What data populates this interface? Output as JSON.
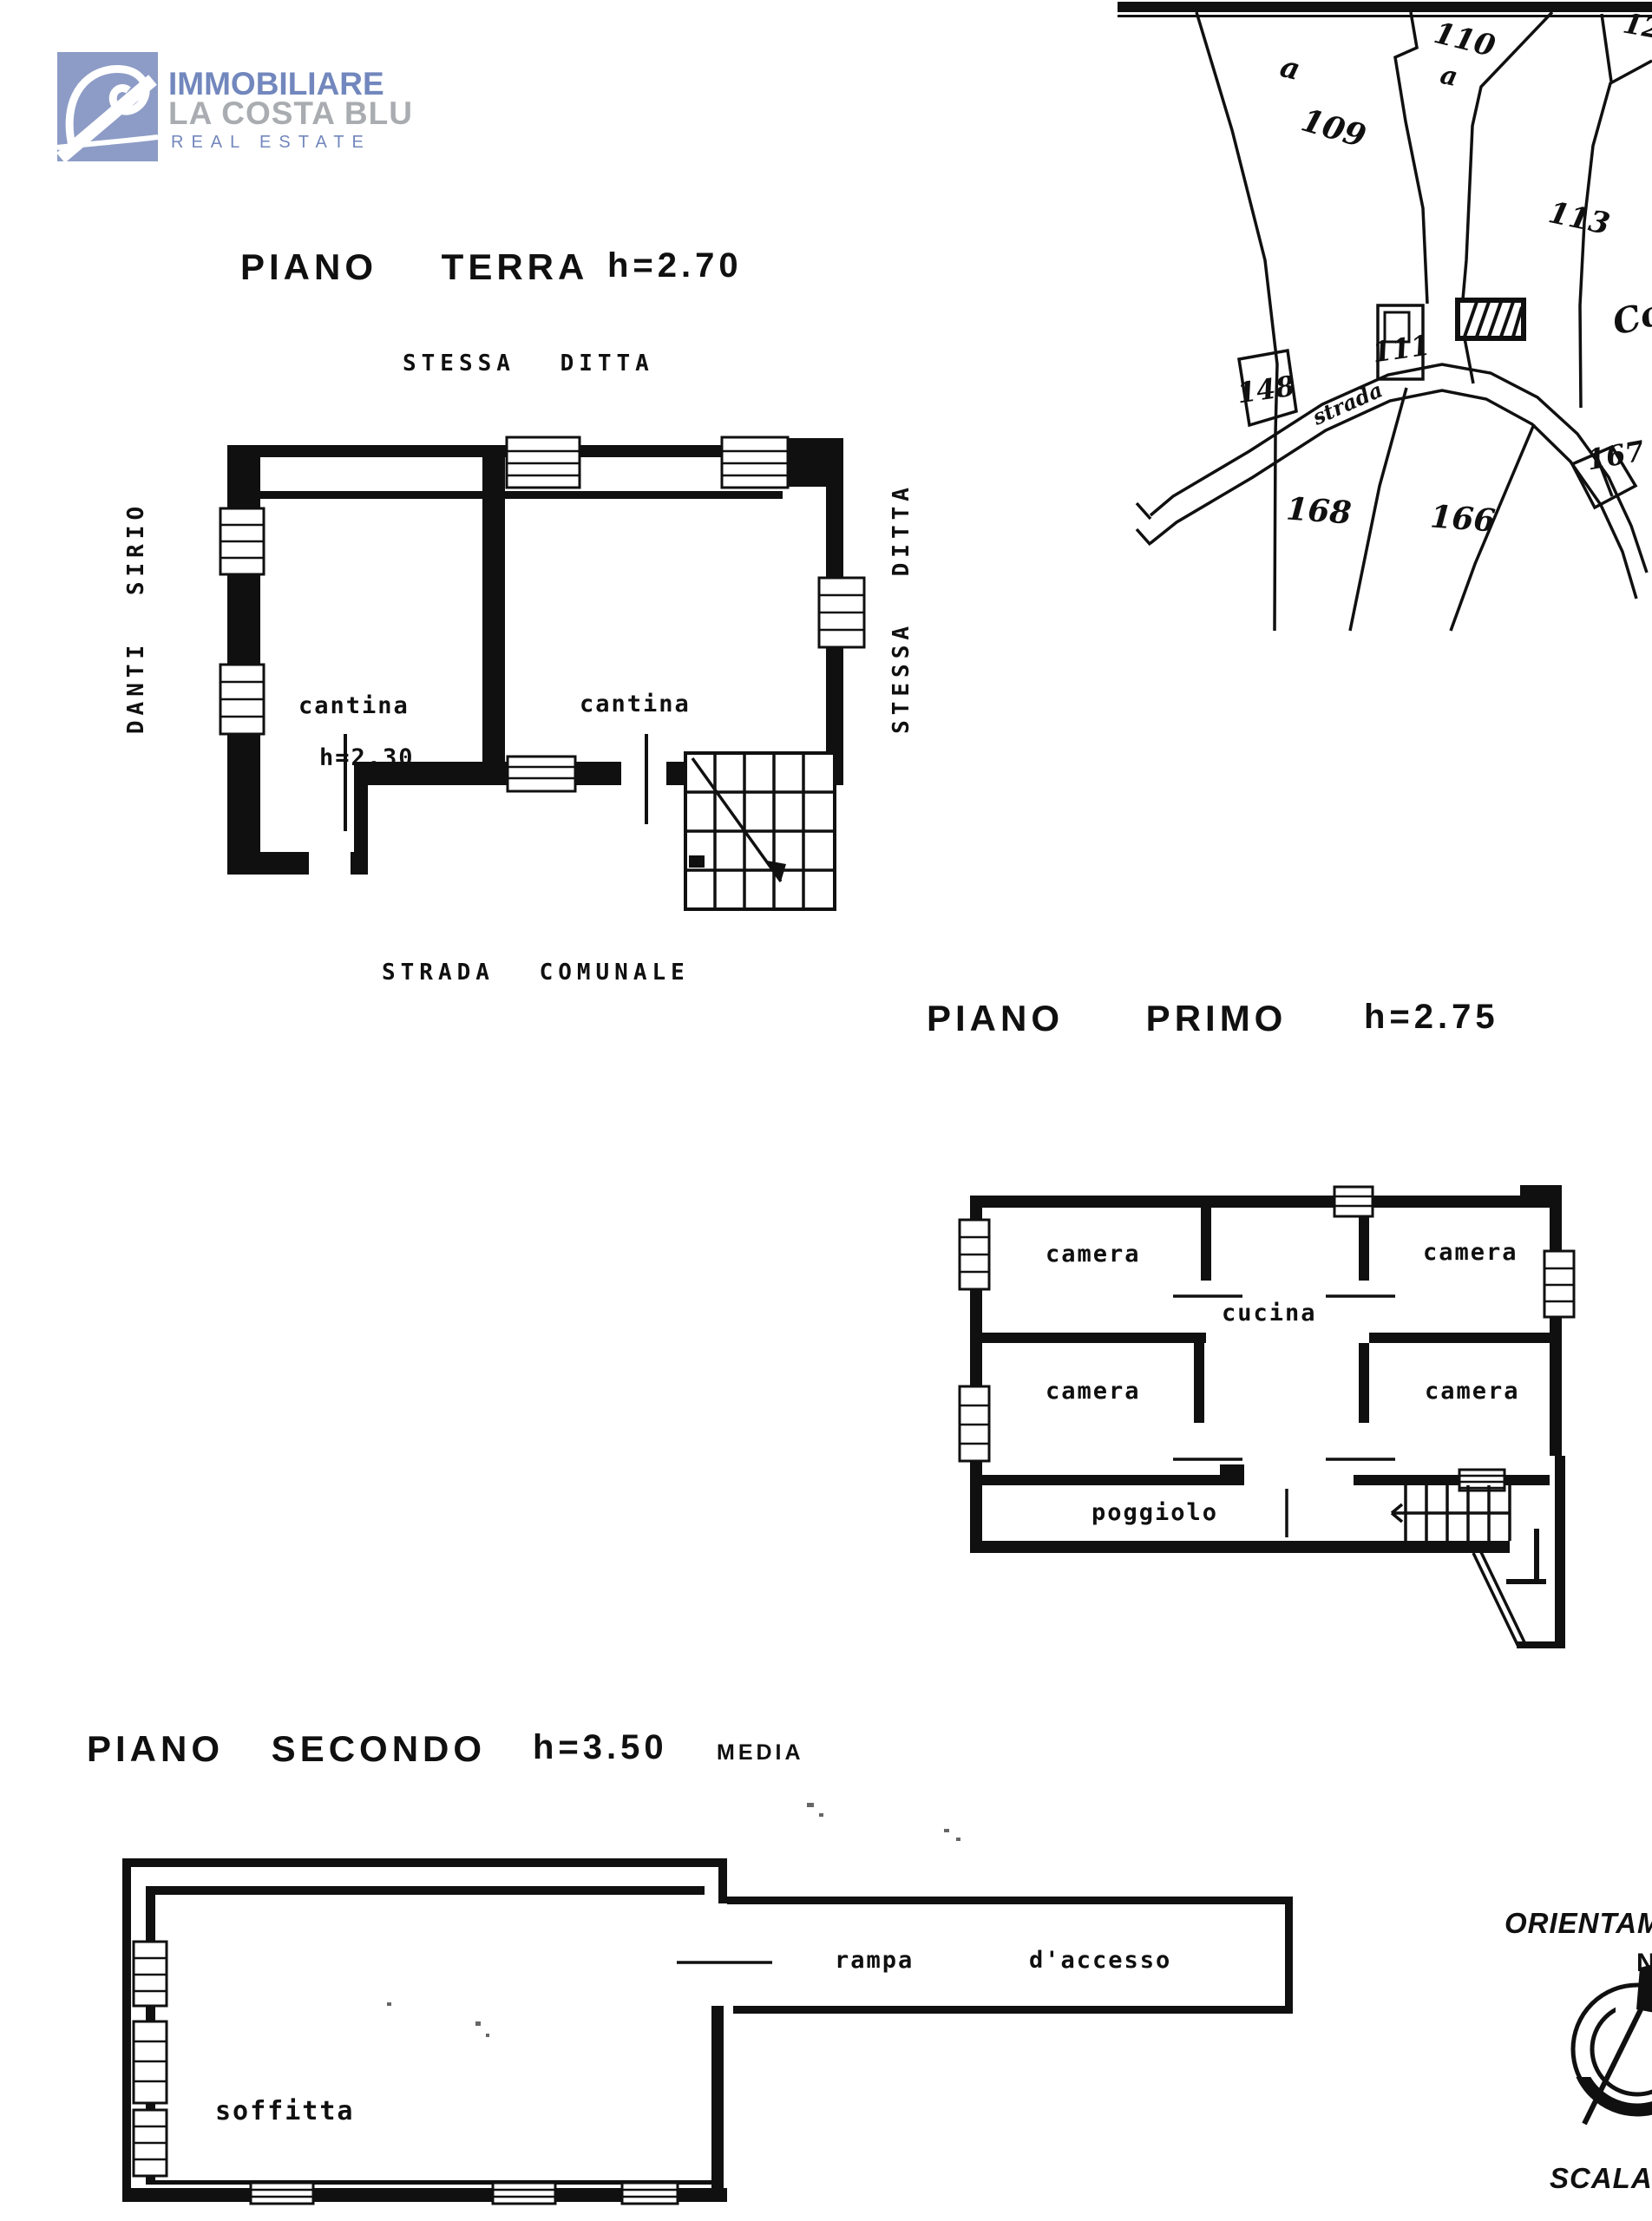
{
  "page": {
    "ink": "#101010",
    "paper": "#ffffff"
  },
  "logo": {
    "line1": "IMMOBILIARE",
    "line2": "LA COSTA BLU",
    "line3": "REAL ESTATE",
    "square_color": "#8d9cc6",
    "text_blue": "#7287bd",
    "text_gray": "#a9acb0"
  },
  "floor_terra": {
    "title": "PIANO TERRA",
    "height_label": "h=2.70",
    "neighbor_top": "STESSA DITTA",
    "neighbor_left": "DANTI SIRIO",
    "neighbor_right": "STESSA DITTA",
    "street": "STRADA COMUNALE",
    "room_left": "cantina",
    "room_left_height": "h=2.30",
    "room_right": "cantina"
  },
  "floor_primo": {
    "title": "PIANO PRIMO",
    "height_label": "h=2.75",
    "room_tl": "camera",
    "room_tr": "camera",
    "room_bl": "camera",
    "room_br": "camera",
    "kitchen": "cucina",
    "balcony": "poggiolo"
  },
  "floor_secondo": {
    "title": "PIANO SECONDO",
    "height_label": "h=3.50",
    "height_note": "MEDIA",
    "attic": "soffitta",
    "ramp_word1": "rampa",
    "ramp_word2": "d'accesso"
  },
  "cadastral_map": {
    "parcel_110": "110",
    "parcel_109": "109",
    "parcel_113": "113",
    "parcel_148": "148",
    "parcel_111": "111",
    "parcel_168": "168",
    "parcel_166": "166",
    "parcel_167": "167",
    "parcel_corner": "12",
    "letter_a_109": "a",
    "letter_a_110": "a",
    "road_word": "strada",
    "road_name_partial": "Co"
  },
  "compass": {
    "label": "ORIENTAMENTO",
    "north": "N",
    "scale_label": "SCALA"
  }
}
